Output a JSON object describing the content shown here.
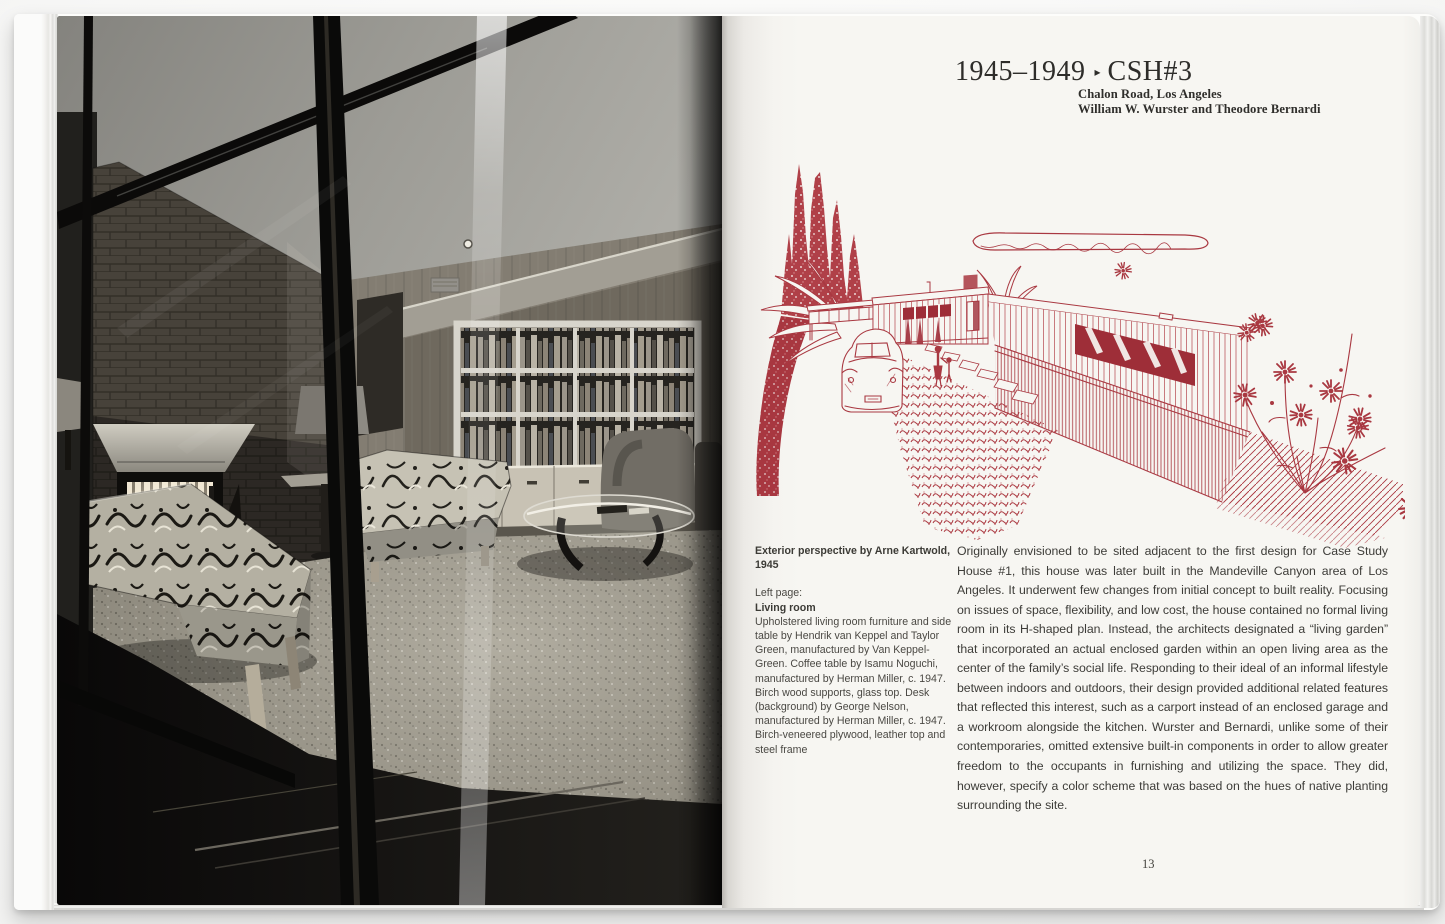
{
  "book": {
    "right_page": {
      "title": {
        "years": "1945–1949",
        "separator": "▸",
        "code": "CSH#3"
      },
      "subtitle": {
        "line1": "Chalon Road, Los Angeles",
        "line2": "William W. Wurster and Theodore Bernardi"
      },
      "illustration": {
        "alt": "red-ink-exterior-perspective-drawing-of-csh3",
        "ink_color": "#a93841"
      },
      "caption": {
        "credit": "Exterior perspective by Arne Kartwold, 1945",
        "page_ref": "Left page:",
        "subject": "Living room",
        "body": "Upholstered living room furniture and side table by Hendrik van Keppel and Taylor Green, manufactured by Van Keppel-Green. Coffee table by Isamu Noguchi, manufactured by Herman Miller, c. 1947. Birch wood supports, glass top. Desk (background) by George Nelson, manufactured by Herman Miller, c. 1947. Birch-veneered plywood, leather top and steel frame"
      },
      "body_text": "Originally envisioned to be sited adjacent to the first design for Case Study House #1, this house was later built in the Mandeville Canyon area of Los Angeles. It underwent few changes from initial concept to built reality. Focusing on issues of space, flexibility, and low cost, the house contained no formal living room in its H-shaped plan. Instead, the architects designated a “living garden” that incorporated an actual enclosed garden within an open living area as the center of the family’s social life. Responding to their ideal of an informal lifestyle between indoors and outdoors, their design provided additional related features that reflected this interest, such as a carport instead of an enclosed garage and a workroom alongside the kitchen. Wurster and Bernardi, unlike some of their contemporaries, omitted extensive built-in components in order to allow greater freedom to the occupants in furnishing and utilizing the space. They did, however, specify a color scheme that was based on the hues of native planting surrounding the site.",
      "page_number": "13"
    },
    "left_page": {
      "photo_alt": "black-and-white-photograph-living-room-through-glass-wall"
    }
  }
}
